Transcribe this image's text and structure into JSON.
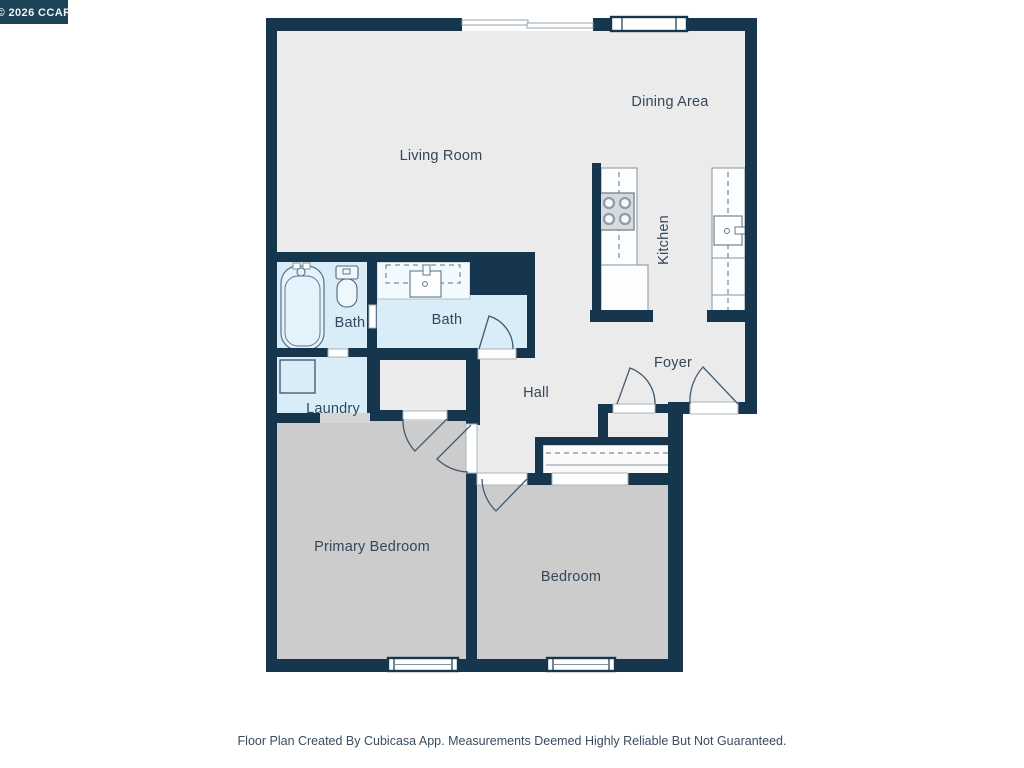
{
  "watermark": {
    "text": "© 2026 CCAR"
  },
  "rooms": {
    "living_room": "Living Room",
    "dining_area": "Dining Area",
    "kitchen": "Kitchen",
    "bath_1": "Bath",
    "bath_2": "Bath",
    "laundry": "Laundry",
    "hall": "Hall",
    "foyer": "Foyer",
    "primary_bedroom": "Primary Bedroom",
    "bedroom": "Bedroom"
  },
  "footer": {
    "disclaimer": "Floor Plan Created By Cubicasa App. Measurements Deemed Highly Reliable But Not Guaranteed."
  },
  "colors": {
    "wall": "#16364d",
    "floor": "#ebebeb",
    "bedroom_carpet": "#cccccc",
    "wet_room_floor": "#d9edf8",
    "badge_background": "#1d4456",
    "label_text": "#33475c"
  },
  "fixtures": [
    "bathtub",
    "toilet",
    "vanity-sink",
    "kitchen-stove",
    "kitchen-sink",
    "washer",
    "closet-rod",
    "door-swing",
    "window"
  ]
}
